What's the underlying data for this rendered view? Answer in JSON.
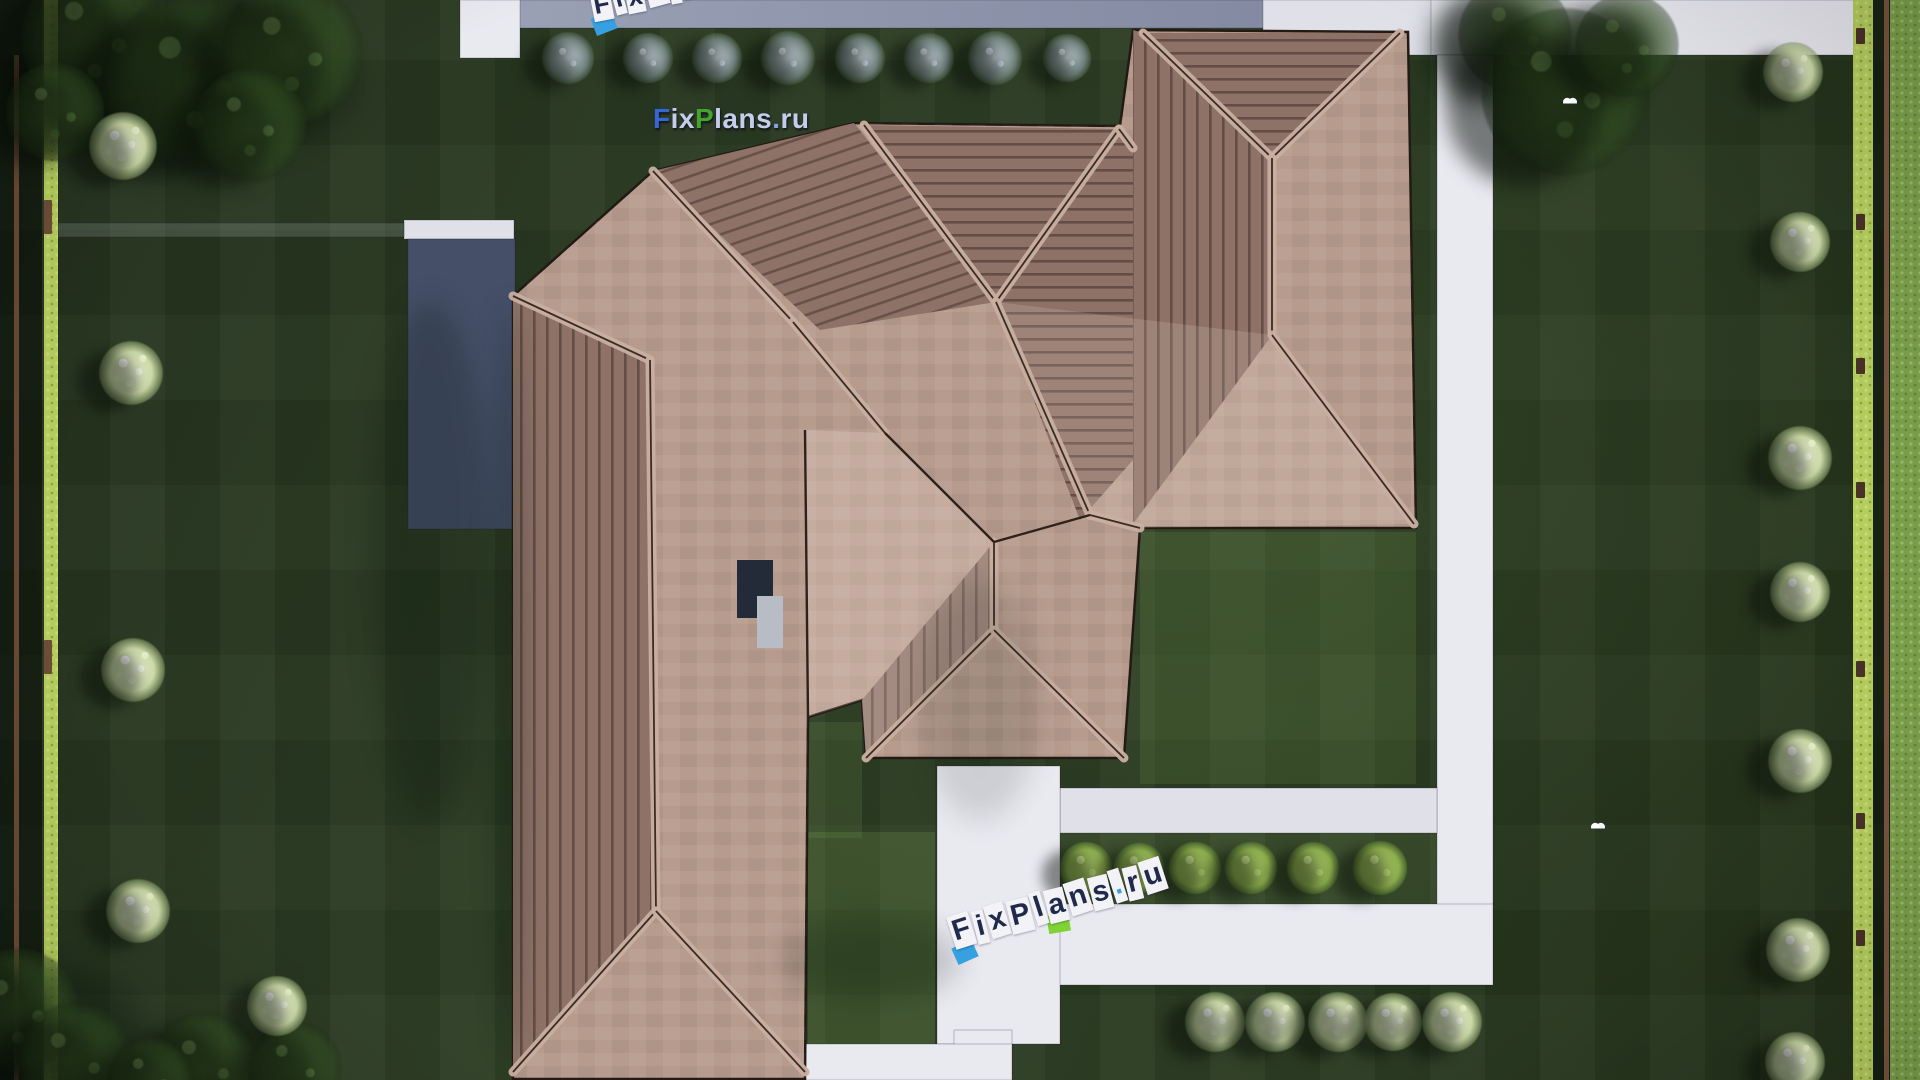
{
  "scene": {
    "kind": "aerial top-down 3D render of a single-family house site plan",
    "width": 1920,
    "height": 1080
  },
  "watermarks": {
    "main": {
      "segments": [
        {
          "t": "F",
          "c": "#3565d6"
        },
        {
          "t": "ix",
          "c": "#c4cdec"
        },
        {
          "t": "P",
          "c": "#43a32e"
        },
        {
          "t": "lans",
          "c": "#c4cdec"
        },
        {
          "t": ".",
          "c": "#7fa3e8"
        },
        {
          "t": "ru",
          "c": "#c4cdec"
        }
      ]
    },
    "stencil_bottom": {
      "text": "FixPlans.ru"
    },
    "stencil_top_partial": {
      "text": "FixPlans.ru"
    }
  },
  "palette": {
    "lawn_dark": "#2c3c23",
    "lawn_outer": "#7ca24b",
    "hedge": "#b7cf5d",
    "fence_brown": "#6b4a35",
    "path_white": "#e9e9f0",
    "path_soft": "#dfe0e8",
    "driveway_slate_1": "#9aa0b4",
    "driveway_slate_2": "#7e859e",
    "terrace_slate": "#454f68",
    "roof_smooth": "#b79c8e",
    "roof_striped_base": "#8e7268",
    "roof_stripe_line": "#3f2f28",
    "ridge_band": "#cab0a1",
    "ridge_line": "#3a2b24",
    "chimney_dark": "#232b38",
    "chimney_light": "#b8bcc4",
    "accent_blue": "#36a0e0",
    "accent_green": "#7fd335",
    "tile": "#f3f3f7"
  },
  "ground": {
    "hedge_left": {
      "x": 44,
      "y": 0,
      "w": 14,
      "h": 1080
    },
    "hedge_right": {
      "x": 1853,
      "y": 0,
      "w": 20,
      "h": 1080
    },
    "shadow_left_strip": {
      "x": 0,
      "y": 0,
      "w": 42,
      "h": 1080
    },
    "shadow_right_strip": {
      "x": 1873,
      "y": 0,
      "w": 17,
      "h": 1080
    },
    "outer_lawn_right": {
      "x": 1890,
      "y": 0,
      "w": 30,
      "h": 1080
    },
    "fence_left": {
      "x": 14,
      "y": 55,
      "w": 5,
      "h": 1025
    },
    "fence_right": {
      "x": 1884,
      "y": 0,
      "w": 5,
      "h": 1080
    },
    "right_hedge_post_y": [
      28,
      214,
      358,
      482,
      661,
      813,
      930
    ],
    "left_hedge_post_y": [
      200,
      640
    ],
    "light_patches": [
      {
        "x": 1140,
        "y": 532,
        "w": 276,
        "h": 252,
        "o": 0.13
      },
      {
        "x": 808,
        "y": 832,
        "w": 127,
        "h": 246,
        "o": 0.16
      },
      {
        "x": 808,
        "y": 722,
        "w": 54,
        "h": 116,
        "o": 0.12
      },
      {
        "x": 1060,
        "y": 833,
        "w": 377,
        "h": 71,
        "o": 0.1
      }
    ]
  },
  "paths": [
    {
      "name": "top-driveway-band",
      "x": 519,
      "y": 0,
      "w": 912,
      "h": 28,
      "fill": "slate"
    },
    {
      "name": "top-left-stub",
      "x": 460,
      "y": 0,
      "w": 60,
      "h": 58,
      "fill": "white"
    },
    {
      "name": "top-right-band-inner",
      "x": 1263,
      "y": 0,
      "w": 170,
      "h": 55,
      "fill": "soft"
    },
    {
      "name": "top-right-band",
      "x": 1431,
      "y": 0,
      "w": 424,
      "h": 55,
      "fill": "white"
    },
    {
      "name": "right-walkway",
      "x": 1437,
      "y": 55,
      "w": 56,
      "h": 930,
      "fill": "white"
    },
    {
      "name": "bottom-right-walkway",
      "x": 1056,
      "y": 904,
      "w": 437,
      "h": 81,
      "fill": "white"
    },
    {
      "name": "patio-band",
      "x": 1060,
      "y": 788,
      "w": 377,
      "h": 45,
      "fill": "soft"
    },
    {
      "name": "center-vertical-walk",
      "x": 937,
      "y": 766,
      "w": 123,
      "h": 278,
      "fill": "white"
    },
    {
      "name": "center-narrow-walk",
      "x": 954,
      "y": 1030,
      "w": 58,
      "h": 50,
      "fill": "white"
    },
    {
      "name": "bottom-left-walk",
      "x": 740,
      "y": 1044,
      "w": 272,
      "h": 36,
      "fill": "white"
    },
    {
      "name": "bottom-sliver",
      "x": 527,
      "y": 1060,
      "w": 213,
      "h": 20,
      "fill": "soft"
    },
    {
      "name": "west-stub",
      "x": 404,
      "y": 220,
      "w": 110,
      "h": 19,
      "fill": "soft"
    },
    {
      "name": "west-faint-path",
      "x": 58,
      "y": 223,
      "w": 346,
      "h": 14,
      "fill": "faint"
    },
    {
      "name": "west-terrace",
      "x": 408,
      "y": 239,
      "w": 107,
      "h": 290,
      "fill": "terrace"
    }
  ],
  "house": {
    "outline": [
      513,
      296,
      653,
      171,
      854,
      123,
      1120,
      126,
      1133,
      30,
      1408,
      32,
      1416,
      528,
      1140,
      528,
      1124,
      758,
      866,
      758,
      862,
      700,
      808,
      717,
      805,
      1079,
      513,
      1079
    ],
    "striped_planes": [
      {
        "name": "nw-gable-slope",
        "pat": "pd",
        "pts": [
          653,
          171,
          854,
          123,
          996,
          302,
          820,
          330
        ]
      },
      {
        "name": "middle-gable-triangle",
        "pat": "ph",
        "pts": [
          864,
          125,
          1119,
          129,
          996,
          302
        ]
      },
      {
        "name": "right-gable-triangle",
        "pat": "ph",
        "pts": [
          1143,
          33,
          1400,
          33,
          1272,
          158
        ]
      },
      {
        "name": "right-inner-slope",
        "pat": "ph",
        "pts": [
          1119,
          129,
          1133,
          148,
          1133,
          460,
          1080,
          520,
          996,
          302
        ]
      },
      {
        "name": "right-west-slope",
        "pat": "pv",
        "pts": [
          1133,
          30,
          1143,
          33,
          1272,
          158,
          1272,
          335,
          1133,
          524
        ]
      },
      {
        "name": "left-wing-west-slope",
        "pat": "pv",
        "pts": [
          513,
          300,
          650,
          360,
          656,
          911,
          513,
          1072
        ]
      },
      {
        "name": "south-porch-west-slope",
        "pat": "pv",
        "pts": [
          994,
          542,
          994,
          630,
          866,
          758,
          862,
          700
        ]
      }
    ],
    "tints": [
      {
        "pts": [
          885,
          433,
          994,
          542,
          994,
          630,
          866,
          758,
          862,
          700,
          808,
          717,
          805,
          430
        ],
        "o": 0.2
      },
      {
        "pts": [
          1272,
          335,
          1414,
          524,
          1140,
          528,
          1090,
          515,
          996,
          302
        ],
        "o": 0.14
      }
    ],
    "ridges": [
      [
        653,
        171,
        793,
        322
      ],
      [
        793,
        322,
        885,
        433
      ],
      [
        864,
        125,
        996,
        302
      ],
      [
        1119,
        129,
        996,
        302
      ],
      [
        1119,
        129,
        1133,
        148
      ],
      [
        996,
        302,
        1090,
        515
      ],
      [
        1090,
        515,
        1140,
        528
      ],
      [
        1143,
        33,
        1272,
        158
      ],
      [
        1400,
        33,
        1272,
        158
      ],
      [
        1272,
        158,
        1272,
        335
      ],
      [
        1272,
        335,
        1414,
        524
      ],
      [
        994,
        542,
        994,
        630
      ],
      [
        994,
        630,
        866,
        758
      ],
      [
        994,
        630,
        1124,
        758
      ],
      [
        513,
        296,
        650,
        360
      ],
      [
        650,
        360,
        656,
        911
      ],
      [
        656,
        911,
        513,
        1072
      ],
      [
        656,
        911,
        805,
        1072
      ]
    ],
    "valleys": [
      [
        885,
        433,
        994,
        542
      ],
      [
        1090,
        515,
        994,
        542
      ],
      [
        805,
        430,
        808,
        717
      ]
    ],
    "chimney": {
      "dark": {
        "x": 737,
        "y": 560,
        "w": 36,
        "h": 58
      },
      "light": {
        "x": 757,
        "y": 596,
        "w": 26,
        "h": 52
      }
    }
  },
  "vegetation": {
    "trees": [
      [
        95,
        38,
        150
      ],
      [
        195,
        80,
        180
      ],
      [
        292,
        52,
        145
      ],
      [
        55,
        112,
        100
      ],
      [
        250,
        125,
        115
      ],
      [
        1515,
        35,
        115
      ],
      [
        1565,
        92,
        170
      ],
      [
        1627,
        45,
        105
      ],
      [
        18,
        1010,
        125
      ],
      [
        75,
        1062,
        120
      ],
      [
        205,
        1068,
        115
      ],
      [
        295,
        1068,
        95
      ],
      [
        150,
        1079,
        85
      ]
    ],
    "white_bushes": [
      [
        123,
        146,
        70
      ],
      [
        131,
        373,
        66
      ],
      [
        133,
        670,
        66
      ],
      [
        138,
        911,
        66
      ],
      [
        277,
        1006,
        62
      ],
      [
        1793,
        72,
        62
      ],
      [
        1800,
        242,
        62
      ],
      [
        1800,
        458,
        66
      ],
      [
        1800,
        592,
        62
      ],
      [
        1800,
        761,
        66
      ],
      [
        1798,
        950,
        66
      ],
      [
        1795,
        1062,
        62
      ],
      [
        1215,
        1022,
        62
      ],
      [
        1275,
        1022,
        62
      ],
      [
        1338,
        1022,
        62
      ],
      [
        1393,
        1022,
        60
      ],
      [
        1452,
        1022,
        62
      ]
    ],
    "pale_bushes": [
      [
        568,
        58,
        54
      ],
      [
        648,
        58,
        52
      ],
      [
        717,
        58,
        52
      ],
      [
        788,
        58,
        56
      ],
      [
        860,
        58,
        52
      ],
      [
        929,
        58,
        52
      ],
      [
        995,
        58,
        56
      ],
      [
        1067,
        58,
        50
      ]
    ],
    "green_bushes": [
      [
        1086,
        868,
        54
      ],
      [
        1139,
        868,
        52
      ],
      [
        1195,
        868,
        54
      ],
      [
        1251,
        868,
        54
      ],
      [
        1313,
        868,
        54
      ],
      [
        1380,
        868,
        56
      ]
    ],
    "birds": [
      [
        1570,
        100
      ],
      [
        1598,
        825
      ]
    ]
  },
  "shadows": [
    [
      430,
      560,
      60,
      260,
      0.22
    ],
    [
      510,
      680,
      14,
      380,
      0.28
    ],
    [
      200,
      85,
      160,
      75,
      0.3
    ],
    [
      1545,
      60,
      95,
      55,
      0.28
    ],
    [
      1470,
      48,
      40,
      55,
      0.3
    ],
    [
      870,
      960,
      90,
      40,
      0.18
    ],
    [
      60,
      1030,
      85,
      60,
      0.3
    ],
    [
      980,
      700,
      60,
      120,
      0.12
    ]
  ]
}
